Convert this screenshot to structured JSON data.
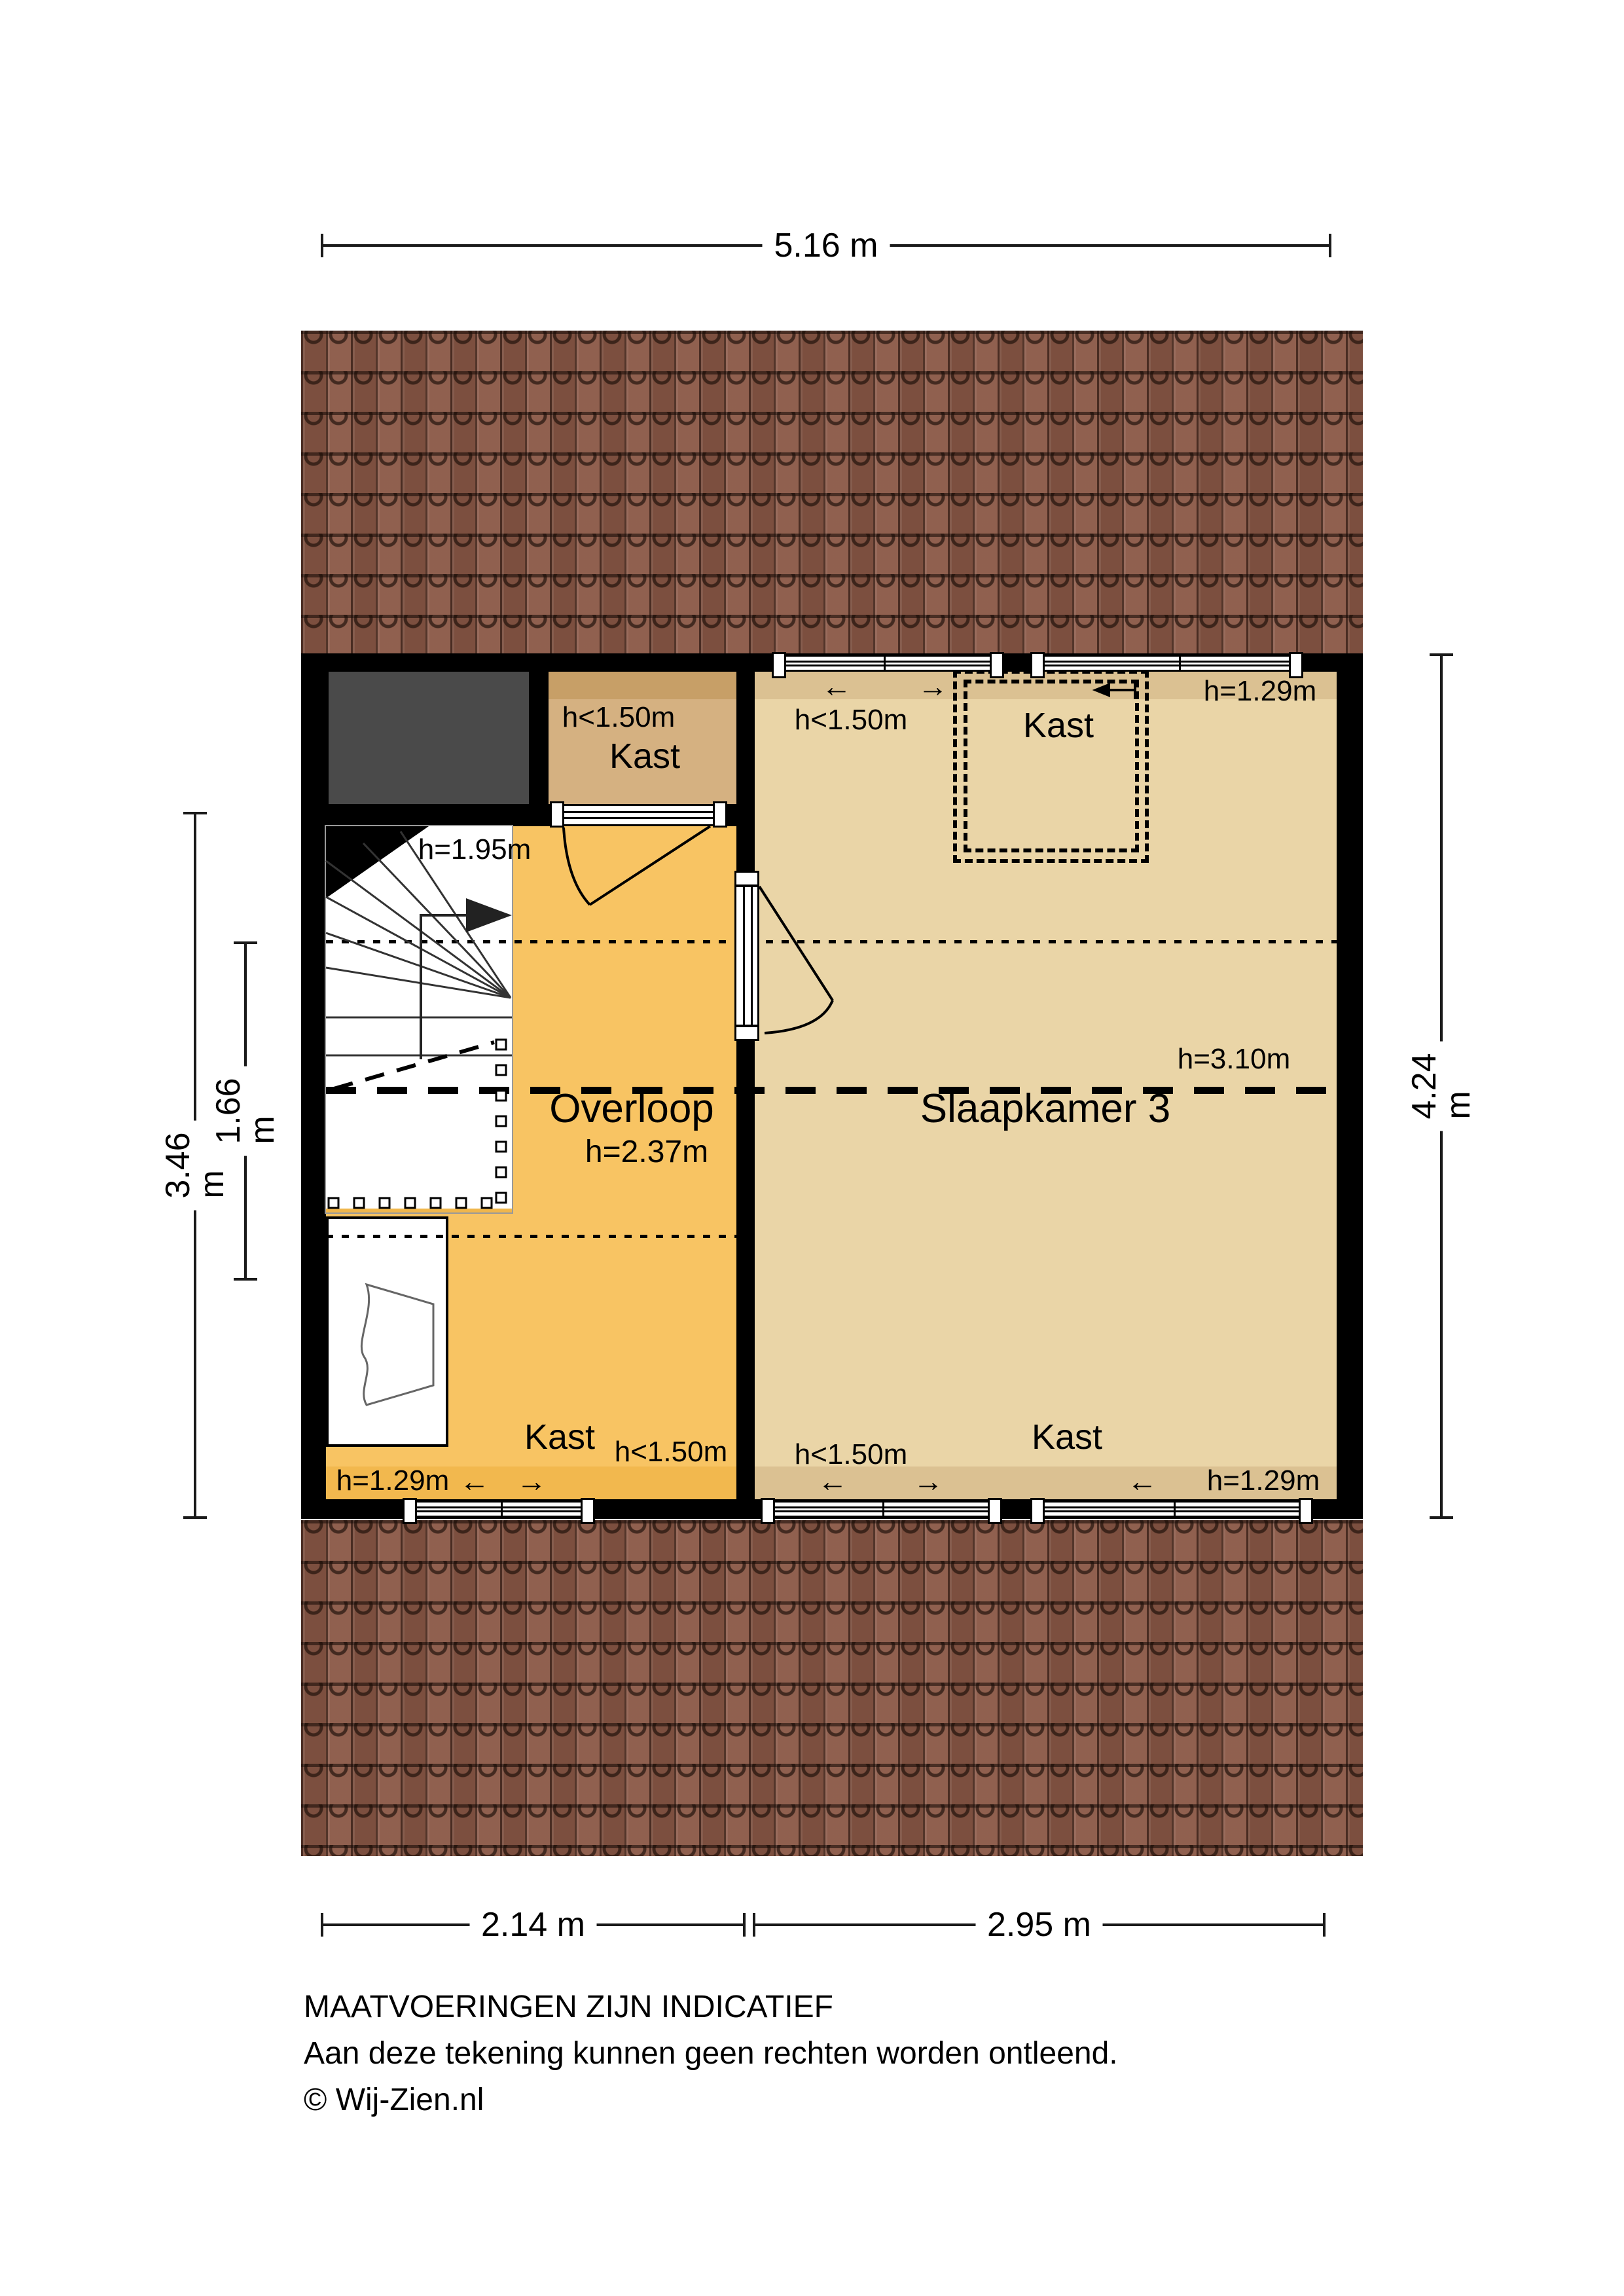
{
  "dimensions": {
    "top": "5.16 m",
    "bottom_left": "2.14 m",
    "bottom_right": "2.95 m",
    "left_outer": "3.46 m",
    "left_inner": "1.66 m",
    "right": "4.24 m"
  },
  "rooms": {
    "kast_topleft": {
      "height_note": "h<1.50m",
      "name": "Kast"
    },
    "stairs": {
      "height_note": "h=1.95m"
    },
    "overloop": {
      "name": "Overloop",
      "height_note": "h=2.37m",
      "kast_label": "Kast",
      "kast_height_note": "h<1.50m",
      "edge_height_note": "h=1.29m",
      "arrow_left": "←",
      "arrow_right": "→"
    },
    "slaapkamer": {
      "name": "Slaapkamer 3",
      "mid_height_note": "h=3.10m",
      "top_edge_height_note": "h=1.29m",
      "top_zone_note": "h<1.50m",
      "kast_dashed_label": "Kast",
      "top_arrow_left": "←",
      "top_arrow_right": "→",
      "bottom_zone_note": "h<1.50m",
      "bottom_kast_label": "Kast",
      "bottom_edge_height_note": "h=1.29m",
      "bottom_arrow_left": "←",
      "bottom_arrow_right": "→",
      "bottom_arrow_left2": "←"
    }
  },
  "footer": {
    "line1": "MAATVOERINGEN ZIJN INDICATIEF",
    "line2": "Aan deze tekening kunnen geen rechten worden ontleend.",
    "line3": "© Wij-Zien.nl"
  },
  "colors": {
    "wall": "#000000",
    "overloop_fill": "#f8c463",
    "overloop_band": "#f2b84e",
    "slaapkamer_fill": "#ead5a7",
    "slaapkamer_band": "#dbc192",
    "kast_fill": "#d5b181",
    "kast_band": "#c79f67",
    "void_gray": "#4a4a4a",
    "roof_base": "#8a5846"
  }
}
